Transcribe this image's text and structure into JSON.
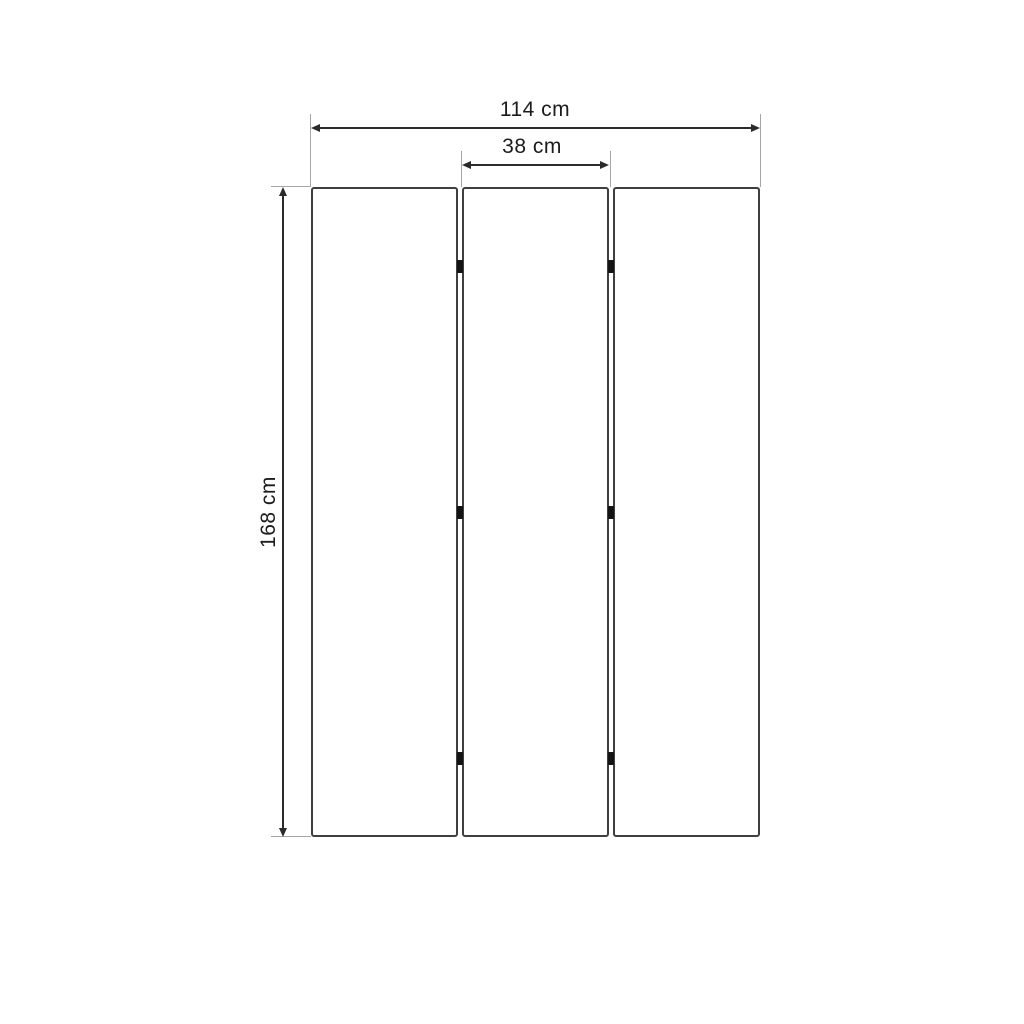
{
  "diagram": {
    "description": "Dimension drawing of a three-panel folding room divider (front view)",
    "dimensions": {
      "total_width": {
        "label": "114 cm",
        "value": 114,
        "unit": "cm"
      },
      "panel_width": {
        "label": "38 cm",
        "value": 38,
        "unit": "cm"
      },
      "height": {
        "label": "168 cm",
        "value": 168,
        "unit": "cm"
      }
    },
    "panels": {
      "count": 3
    },
    "hinges": {
      "rows": 3,
      "columns": 2
    },
    "colors": {
      "background": "#ffffff",
      "panel_border": "#3f3f3f",
      "dimension_line": "#2b2b2b",
      "extension_line": "#a6a6a6",
      "text": "#1c1c1c",
      "hinge": "#141414"
    }
  }
}
